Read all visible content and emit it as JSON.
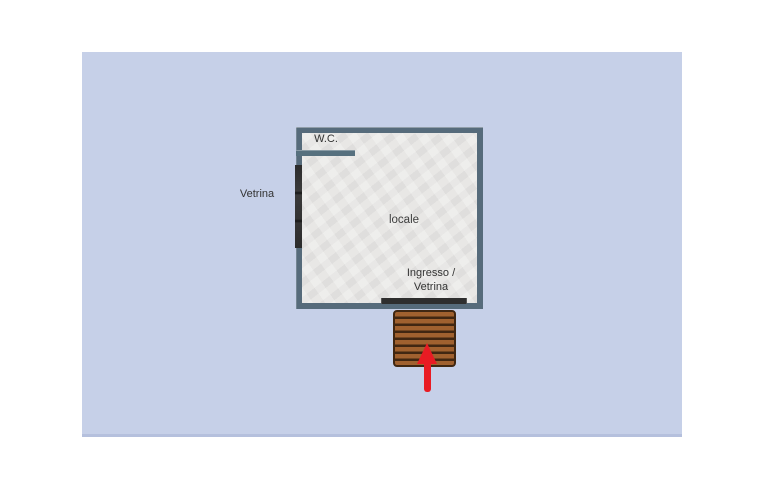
{
  "board": {
    "background_color": "#c6d0e8",
    "bottom_shadow_color": "#b5c0dd",
    "page_background_color": "#ffffff"
  },
  "room": {
    "wall_color": "#566b7b",
    "floor_color": "#e6e5e3"
  },
  "labels": {
    "wc": "W.C.",
    "window_left": "Vetrina",
    "room": "locale",
    "entrance_line1": "Ingresso /",
    "entrance_line2": "Vetrina"
  },
  "features": {
    "window_strip_color": "#303030",
    "entrance_strip_color": "#2e2e2e",
    "deck_color": "#a0612f",
    "deck_plank_color": "#412712",
    "arrow_color": "#e91b23",
    "arrow_direction": "up"
  }
}
